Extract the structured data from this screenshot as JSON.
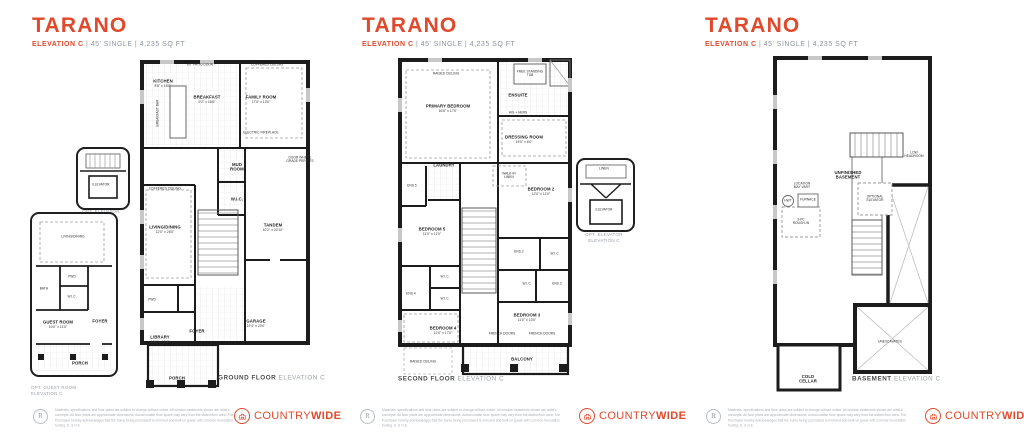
{
  "accent_color": "#e0492c",
  "wall_color": "#1c1c1c",
  "header": {
    "title": "TARANO",
    "sub_bold": "ELEVATION C",
    "sub_rest": " | 45' SINGLE | 4,235 SQ FT"
  },
  "captions": {
    "ground_bold": "GROUND FLOOR",
    "ground_light": " ELEVATION C",
    "second_bold": "SECOND FLOOR",
    "second_light": " ELEVATION C",
    "basement_bold": "BASEMENT",
    "basement_light": " ELEVATION C"
  },
  "g": {
    "kitchen": {
      "t": "KITCHEN",
      "d": "8'6\" x 16'6\""
    },
    "breakfast": {
      "t": "BREAKFAST",
      "d": "9'2\" x 16'6\""
    },
    "family": {
      "t": "FAMILY ROOM",
      "d": "17'0\" x 13'0\""
    },
    "fireplace": "ELECTRIC FIREPLACE",
    "patio_door": "8'0\" PATIO DOOR",
    "coffered1": "COFFERED CEILING",
    "coffered2": "COFFERED CEILING",
    "breakfast_bar": "BREAKFAST BAR",
    "mud": "MUD\nROOM",
    "wic": "W.I.C.",
    "tandem": {
      "t": "TANDEM",
      "d": "10'2\" x 20'10\""
    },
    "living": {
      "t": "LIVING/DINING",
      "d": "12'0\" x 26'0\""
    },
    "grade_note": "DOOR WHERE\nGRADE PERMITS",
    "pwd": "PWD",
    "library": {
      "t": "LIBRARY",
      "d": "10'0\" x 11'0\""
    },
    "foyer": "FOYER",
    "garage": {
      "t": "GARAGE",
      "d": "19'4\" x 20'0\""
    },
    "porch": "PORCH"
  },
  "s": {
    "primary": {
      "t": "PRIMARY BEDROOM",
      "d": "16'6\" x 17'0\""
    },
    "raised1": "RAISED CEILING",
    "ensuite": "ENSUITE",
    "tub": "FREE STANDING\nTUB",
    "hishers": "HIS + HERS",
    "dressing": {
      "t": "DRESSING ROOM",
      "d": "15'0\" x 6'0\""
    },
    "laundry": "LAUNDRY",
    "ens5": "ENS.5",
    "bed5": {
      "t": "BEDROOM 5",
      "d": "11'0\" x 11'0\""
    },
    "linen": "WALK-IN\nLINEN",
    "bed2": {
      "t": "BEDROOM 2",
      "d": "12'0\" x 11'0\""
    },
    "ens2": "ENS.2",
    "wic_a": "W.I.C.",
    "wic_b": "W.I.C.",
    "ens3": "ENS.3",
    "wic_c": "W.I.C.",
    "wic_d": "W.I.C.",
    "ens4": "ENS.4",
    "bed4": {
      "t": "BEDROOM 4",
      "d": "12'0\" x 17'0\""
    },
    "bed3": {
      "t": "BEDROOM 3",
      "d": "11'0\" x 13'0\""
    },
    "french1": "FRENCH DOORS",
    "french2": "FRENCH DOORS",
    "balcony": "BALCONY",
    "raised2": "RAISED CEILING"
  },
  "b": {
    "unfinished": "UNFINISHED\nBASEMENT",
    "low_headroom": "LOW\nHEADROOM",
    "location": "LOCATION\nMAY VARY",
    "hwt": "HWT",
    "furnace": "FURNACE",
    "roughin": "3-PC\nROUGH-IN",
    "opt_elev": "OPTIONAL\nELEVATOR",
    "unexcavated": "UNEXCAVATED",
    "cold": "COLD\nCELLAR"
  },
  "insets": {
    "elevator1": {
      "elevator": "ELEVATOR",
      "caption": "OPT. ELEVATOR\nELEVATION C"
    },
    "guest": {
      "living": "LIVING/DINING",
      "bath": "BATH",
      "pwd": "PWD",
      "wic": "W.I.C.",
      "guest": {
        "t": "GUEST ROOM",
        "d": "10'0\" x 11'0\""
      },
      "foyer": "FOYER",
      "porch": "PORCH",
      "caption": "OPT. GUEST ROOM\nELEVATION C"
    },
    "elevator2": {
      "linen": "LINEN",
      "elevator": "ELEVATOR",
      "caption": "OPT. ELEVATOR\nELEVATION C"
    }
  },
  "footer": {
    "reg": "R",
    "disclaimer": "Materials, specifications and floor plans are subject to change without notice. All window treatments shown are artist's concepts. All floor plans are approximate dimensions. Actual usable floor space may vary from the stated floor area. The Purchaser hereby acknowledges that the home being purchased is mirrored and built on grade with common foundation footing. E. & O.E.",
    "brand_a": "COUNTRY",
    "brand_b": "WIDE"
  }
}
